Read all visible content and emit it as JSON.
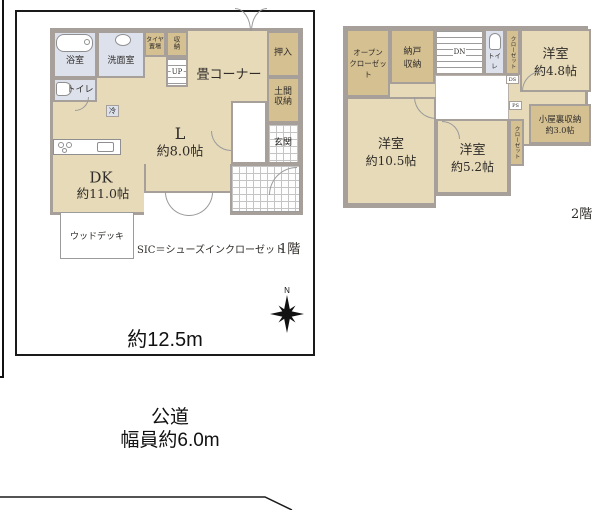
{
  "floor1": {
    "label": "1階",
    "note": "SIC＝シューズインクローゼット",
    "bath": "浴室",
    "wash": "洗面室",
    "toilet": "トイレ",
    "tire1": "タイヤ",
    "tire2": "置場",
    "sto1": "収",
    "sto2": "納",
    "up": "UP",
    "tatami": "畳コーナー",
    "oshiire": "押入",
    "doma1": "土間",
    "doma2": "収納",
    "genkan": "玄関",
    "l_name": "L",
    "l_size": "約8.0帖",
    "dk_name": "DK",
    "dk_size": "約11.0帖",
    "deck": "ウッドデッキ",
    "fridge": "冷"
  },
  "floor2": {
    "label": "2階",
    "open1": "オープン",
    "open2": "クローゼット",
    "nando1": "納戸",
    "nando2": "収納",
    "dn": "DN",
    "toilet": "トイレ",
    "closet_a": "クローゼット",
    "ds": "DS",
    "ps": "PS",
    "room48_name": "洋室",
    "room48_size": "約4.8帖",
    "attic_name": "小屋裏収納",
    "attic_size": "約3.0帖",
    "closet_b": "クローゼット",
    "room105_name": "洋室",
    "room105_size": "約10.5帖",
    "room52_name": "洋室",
    "room52_size": "約5.2帖"
  },
  "site": {
    "width_label": "約12.5m"
  },
  "road": {
    "name": "公道",
    "width": "幅員約6.0m"
  },
  "compass": {
    "north": "N"
  },
  "colors": {
    "room_fill": "#e7dab8",
    "closet_fill": "#d5c092",
    "wet_fill": "#dce1ec",
    "wall": "#a7a09a",
    "boundary": "#111111"
  }
}
